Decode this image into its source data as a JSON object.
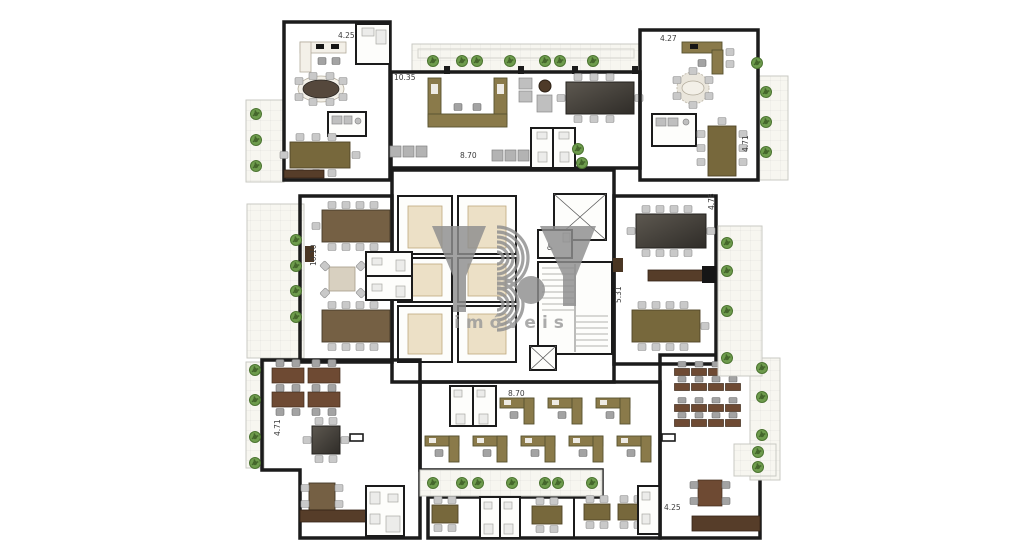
{
  "watermark": {
    "brand": "YBY",
    "tagline": "imóveis"
  },
  "dimensions": {
    "top_left_room_width": "4.25",
    "top_center_left": "10.35",
    "reception_width": "8.70",
    "top_right_room_width": "4.27",
    "top_right_depth": "4.71",
    "right_room_depth": "4.78",
    "left_room_height": "10.10",
    "right_corridor": "5.31",
    "bottom_center_width": "8.70",
    "bottom_left_depth": "4.71",
    "bottom_right_width": "4.25"
  },
  "icons": {
    "accessible_wc": "♿"
  },
  "colors": {
    "wall": "#1b1b1b",
    "floor": "#e3cbaa",
    "core": "#efe8d8",
    "terrace": "#f7f6f0",
    "plant": "#6e9c4d",
    "plant-dark": "#45672c",
    "olive": "#8a7a4a",
    "olive2": "#77683c",
    "brown": "#756044",
    "desk": "#6e4a33",
    "chair": "#c9c9c9",
    "white-room": "#fdfdfb",
    "watermark": "#8e8e8e"
  }
}
